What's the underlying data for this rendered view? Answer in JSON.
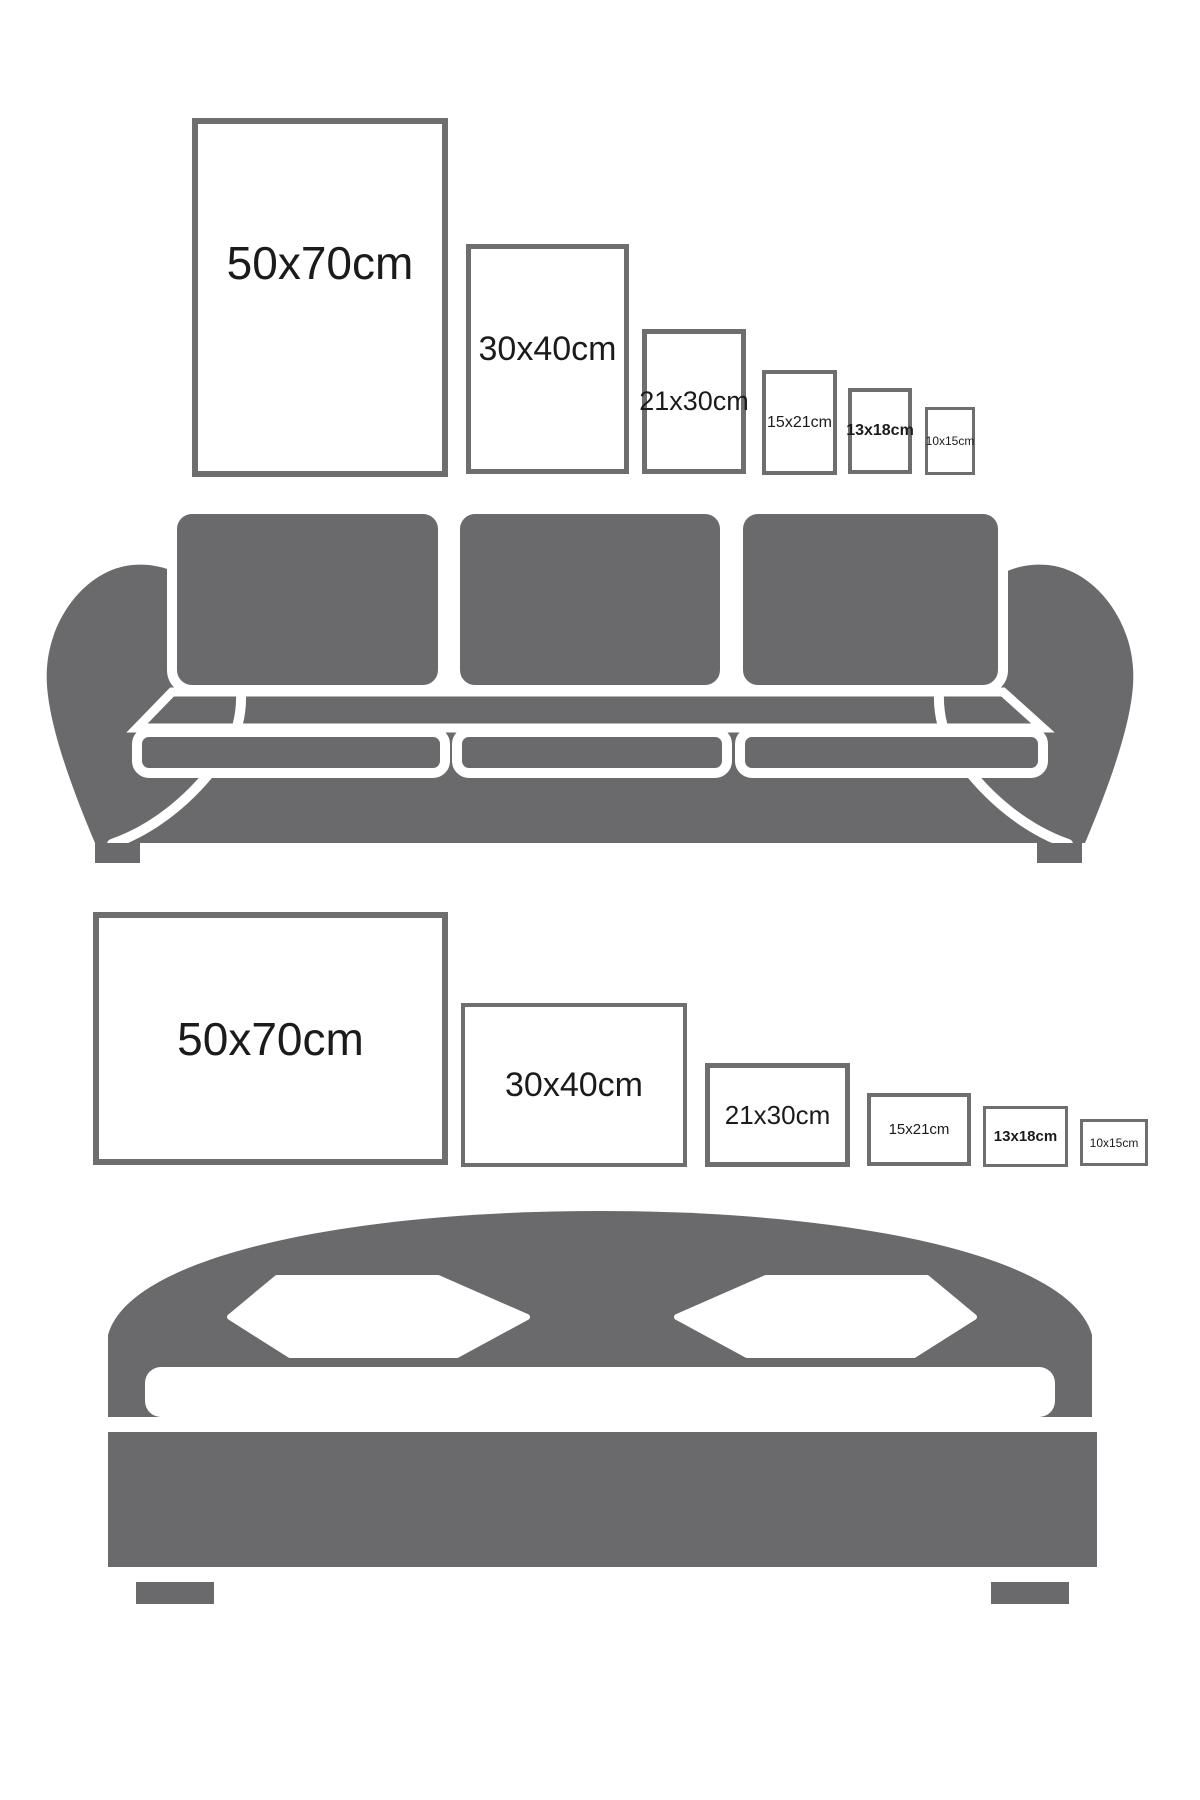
{
  "colors": {
    "background": "#ffffff",
    "silhouette_gray": "#6a696b",
    "frame_border_gray": "#6e6e6e",
    "label_text": "#1b1b1b"
  },
  "rows": [
    {
      "name": "portrait-frames-above-sofa",
      "orientation": "portrait",
      "frames": [
        {
          "label": "50x70cm",
          "width_cm": 50,
          "height_cm": 70
        },
        {
          "label": "30x40cm",
          "width_cm": 30,
          "height_cm": 40
        },
        {
          "label": "21x30cm",
          "width_cm": 21,
          "height_cm": 30
        },
        {
          "label": "15x21cm",
          "width_cm": 15,
          "height_cm": 21
        },
        {
          "label": "13x18cm",
          "width_cm": 13,
          "height_cm": 18
        },
        {
          "label": "10x15cm",
          "width_cm": 10,
          "height_cm": 15
        }
      ]
    },
    {
      "name": "landscape-frames-above-bed",
      "orientation": "landscape",
      "frames": [
        {
          "label": "50x70cm",
          "width_cm": 70,
          "height_cm": 50
        },
        {
          "label": "30x40cm",
          "width_cm": 40,
          "height_cm": 30
        },
        {
          "label": "21x30cm",
          "width_cm": 30,
          "height_cm": 21
        },
        {
          "label": "15x21cm",
          "width_cm": 21,
          "height_cm": 15
        },
        {
          "label": "13x18cm",
          "width_cm": 18,
          "height_cm": 13
        },
        {
          "label": "10x15cm",
          "width_cm": 15,
          "height_cm": 10
        }
      ]
    }
  ],
  "illustrations": [
    {
      "name": "sofa",
      "description": "three-seat sofa silhouette"
    },
    {
      "name": "bed",
      "description": "double bed with arched headboard silhouette"
    }
  ]
}
